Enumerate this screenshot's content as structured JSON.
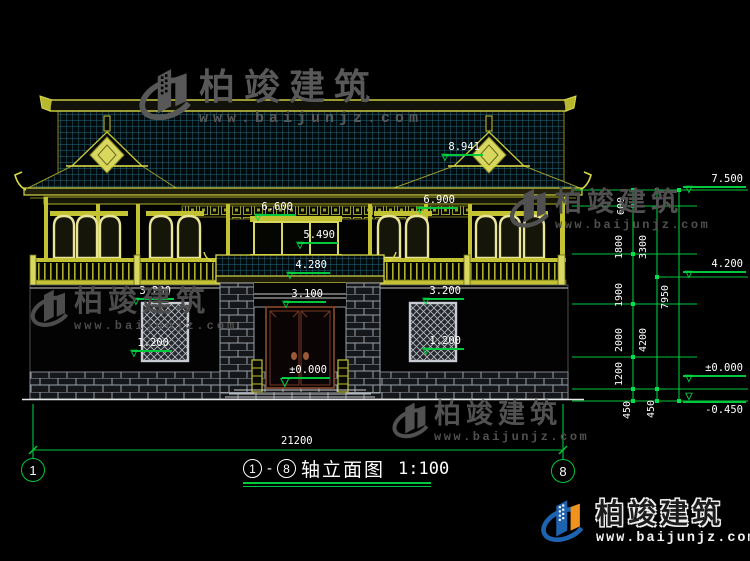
{
  "watermark": {
    "brand": "柏竣建筑",
    "site": "www.baijunjz.com"
  },
  "logo": {
    "brand": "柏竣建筑",
    "site": "www.baijunjz.com"
  },
  "title": {
    "axis_from": "1",
    "dash": "-",
    "axis_to": "8",
    "name": "轴立面图",
    "scale": "1:100"
  },
  "axes": {
    "left_bubble": "1",
    "right_bubble": "8"
  },
  "dims": {
    "total_width": "21200",
    "chain_inner": [
      "600",
      "1800",
      "1900",
      "2000",
      "1200",
      "450"
    ],
    "chain_mid": [
      "3300",
      "4200",
      "450"
    ],
    "chain_outer": [
      "7950"
    ],
    "levels_right": [
      "7.500",
      "4.200",
      "±0.000",
      "-0.450"
    ]
  },
  "elev": {
    "ridge": "8.941",
    "beam_left": "6.600",
    "beam_right": "6.900",
    "transom": "5.490",
    "canopy": "4.280",
    "door_head": "3.100",
    "zero": "±0.000",
    "win_head": "3.200",
    "win_sill": "1.200"
  },
  "colors": {
    "background": "#000000",
    "cad_yellow": "#c2c232",
    "cad_bright_yellow": "#e8e49a",
    "cad_green": "#00c83c",
    "tile_line": "#256c80",
    "white": "#ffffff",
    "brick_line": "#9aa1ab",
    "door_brown": "#8a4a30",
    "watermark_gray": "#565656",
    "logo_blue": "#1e63b0",
    "logo_orange": "#f0921e"
  }
}
